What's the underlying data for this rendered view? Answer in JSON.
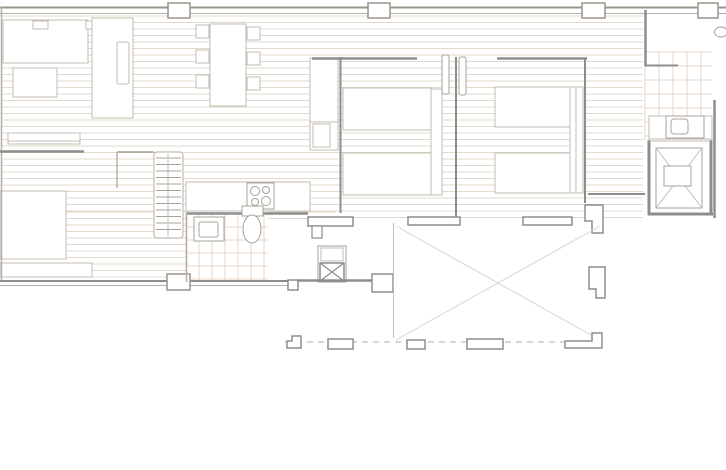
{
  "meta": {
    "title": "apartment-floor-plan",
    "canvas_w": 726,
    "canvas_h": 470,
    "bg": "#ffffff"
  },
  "palette": {
    "wall": "#8d8d8d",
    "wall_mid": "#9a948b",
    "wall_light": "#b6afa7",
    "line": "#c3bbb1",
    "line_dark": "#a8a198",
    "hatch": "#e2d8cc",
    "tile": "#e7d5c8",
    "faint": "#dcd4c9"
  },
  "shapes": [
    {
      "name": "floor-hatch-living",
      "type": "hatch",
      "x": 2,
      "y": 16,
      "w": 334,
      "h": 196,
      "step": 6.5
    },
    {
      "name": "floor-hatch-lower-left",
      "type": "hatch",
      "x": 2,
      "y": 212,
      "w": 184,
      "h": 68,
      "step": 6.5
    },
    {
      "name": "floor-hatch-bedrooms",
      "type": "hatch",
      "x": 336,
      "y": 16,
      "w": 307,
      "h": 202,
      "step": 6.5
    },
    {
      "name": "floor-hatch-utility",
      "type": "hatch",
      "x": 268,
      "y": 212,
      "w": 68,
      "h": 9,
      "step": 6.5
    },
    {
      "name": "tile-grid-bathroom",
      "type": "grid",
      "x": 186,
      "y": 214,
      "w": 82,
      "h": 68,
      "step": 13
    },
    {
      "name": "tile-grid-ensuite",
      "type": "grid",
      "x": 645,
      "y": 52,
      "w": 67,
      "h": 88,
      "step": 14
    },
    {
      "name": "sideboard",
      "type": "rect",
      "x": 3,
      "y": 20,
      "w": 85,
      "h": 43,
      "stroke": "line",
      "sw": 1,
      "fill": "white"
    },
    {
      "name": "sideboard-item",
      "type": "rect",
      "x": 33,
      "y": 21,
      "w": 15,
      "h": 8,
      "stroke": "line",
      "sw": 1,
      "fill": "white"
    },
    {
      "name": "sideboard-item-2",
      "type": "rect",
      "x": 86,
      "y": 21,
      "w": 12,
      "h": 8,
      "stroke": "line",
      "sw": 1,
      "fill": "white"
    },
    {
      "name": "coffee-table",
      "type": "rect",
      "x": 13,
      "y": 68,
      "w": 44,
      "h": 29,
      "stroke": "line",
      "sw": 1,
      "fill": "white"
    },
    {
      "name": "sofa",
      "type": "rect",
      "x": 92,
      "y": 18,
      "w": 41,
      "h": 100,
      "stroke": "line",
      "sw": 1,
      "fill": "white"
    },
    {
      "name": "sofa-cushion",
      "type": "rect",
      "x": 117,
      "y": 42,
      "w": 12,
      "h": 42,
      "rx": 2,
      "stroke": "line",
      "sw": 1,
      "fill": "white"
    },
    {
      "name": "dining-table",
      "type": "rect",
      "x": 210,
      "y": 24,
      "w": 36,
      "h": 82,
      "stroke": "line",
      "sw": 1,
      "fill": "white"
    },
    {
      "name": "chair-1",
      "type": "rect",
      "x": 196,
      "y": 25,
      "w": 13,
      "h": 13,
      "stroke": "line",
      "sw": 1,
      "fill": "white"
    },
    {
      "name": "chair-2",
      "type": "rect",
      "x": 196,
      "y": 50,
      "w": 13,
      "h": 13,
      "stroke": "line",
      "sw": 1,
      "fill": "white"
    },
    {
      "name": "chair-3",
      "type": "rect",
      "x": 196,
      "y": 75,
      "w": 13,
      "h": 13,
      "stroke": "line",
      "sw": 1,
      "fill": "white"
    },
    {
      "name": "chair-4",
      "type": "rect",
      "x": 247,
      "y": 27,
      "w": 13,
      "h": 13,
      "stroke": "line",
      "sw": 1,
      "fill": "white"
    },
    {
      "name": "chair-5",
      "type": "rect",
      "x": 247,
      "y": 52,
      "w": 13,
      "h": 13,
      "stroke": "line",
      "sw": 1,
      "fill": "white"
    },
    {
      "name": "chair-6",
      "type": "rect",
      "x": 247,
      "y": 77,
      "w": 13,
      "h": 13,
      "stroke": "line",
      "sw": 1,
      "fill": "white"
    },
    {
      "name": "wall-console",
      "type": "rect",
      "x": 8,
      "y": 133,
      "w": 72,
      "h": 11,
      "stroke": "line",
      "sw": 1,
      "fill": "white"
    },
    {
      "name": "wall-console-shelf",
      "type": "line",
      "x1": 8,
      "y1": 141,
      "x2": 80,
      "y2": 141,
      "stroke": "line",
      "sw": 1
    },
    {
      "name": "daybed",
      "type": "rect",
      "x": 0,
      "y": 191,
      "w": 66,
      "h": 68,
      "stroke": "line",
      "sw": 1,
      "fill": "white"
    },
    {
      "name": "low-sideboard",
      "type": "rect",
      "x": 0,
      "y": 263,
      "w": 92,
      "h": 14,
      "stroke": "line",
      "sw": 1,
      "fill": "white"
    },
    {
      "name": "stairs",
      "type": "rect",
      "x": 154,
      "y": 152,
      "w": 29,
      "h": 86,
      "rx": 3,
      "stroke": "line",
      "sw": 1.2,
      "fill": "white"
    },
    {
      "name": "stairs-treads",
      "type": "rungs",
      "x": 156,
      "y": 158,
      "w": 25,
      "h": 76,
      "step": 6.5,
      "stroke": "line_dark"
    },
    {
      "name": "stairs-rail",
      "type": "line",
      "x1": 168,
      "y1": 154,
      "x2": 168,
      "y2": 236,
      "stroke": "line",
      "sw": 1
    },
    {
      "name": "kitchen-counter",
      "type": "rect",
      "x": 186,
      "y": 182,
      "w": 124,
      "h": 29,
      "stroke": "line",
      "sw": 1,
      "fill": "white"
    },
    {
      "name": "cooktop",
      "type": "rect",
      "x": 247,
      "y": 183,
      "w": 27,
      "h": 26,
      "stroke": "line_dark",
      "sw": 1,
      "fill": "white"
    },
    {
      "name": "burner-1",
      "type": "circle",
      "cx": 255,
      "cy": 191,
      "r": 4.5,
      "stroke": "line_dark",
      "sw": 1
    },
    {
      "name": "burner-2",
      "type": "circle",
      "cx": 266,
      "cy": 190,
      "r": 3.5,
      "stroke": "line_dark",
      "sw": 1
    },
    {
      "name": "burner-3",
      "type": "circle",
      "cx": 255,
      "cy": 202,
      "r": 3.5,
      "stroke": "line_dark",
      "sw": 1
    },
    {
      "name": "burner-4",
      "type": "circle",
      "cx": 266,
      "cy": 201,
      "r": 4.5,
      "stroke": "line_dark",
      "sw": 1
    },
    {
      "name": "wardrobe",
      "type": "rect",
      "x": 310,
      "y": 58,
      "w": 28,
      "h": 92,
      "stroke": "line",
      "sw": 1,
      "fill": "white"
    },
    {
      "name": "wardrobe-divider",
      "type": "line",
      "x1": 310,
      "y1": 122,
      "x2": 338,
      "y2": 122,
      "stroke": "line",
      "sw": 1
    },
    {
      "name": "wardrobe-shelf",
      "type": "rect",
      "x": 313,
      "y": 124,
      "w": 17,
      "h": 23,
      "stroke": "line",
      "sw": 1,
      "fill": "white"
    },
    {
      "name": "bed-1-left",
      "type": "rect",
      "x": 343,
      "y": 88,
      "w": 88,
      "h": 42,
      "stroke": "line",
      "sw": 1,
      "fill": "white"
    },
    {
      "name": "bed-1-right",
      "type": "rect",
      "x": 343,
      "y": 153,
      "w": 88,
      "h": 42,
      "stroke": "line",
      "sw": 1,
      "fill": "white"
    },
    {
      "name": "bed-1-headboard",
      "type": "rect",
      "x": 431,
      "y": 89,
      "w": 11,
      "h": 106,
      "stroke": "line",
      "sw": 1,
      "fill": "white"
    },
    {
      "name": "bed-2-left",
      "type": "rect",
      "x": 495,
      "y": 87,
      "w": 75,
      "h": 40,
      "stroke": "line",
      "sw": 1,
      "fill": "white"
    },
    {
      "name": "bed-2-right",
      "type": "rect",
      "x": 495,
      "y": 153,
      "w": 75,
      "h": 40,
      "stroke": "line",
      "sw": 1,
      "fill": "white"
    },
    {
      "name": "bed-2-headboard",
      "type": "rect",
      "x": 570,
      "y": 87,
      "w": 13,
      "h": 106,
      "stroke": "line",
      "sw": 1,
      "fill": "white"
    },
    {
      "name": "bed-2-headboard-line",
      "type": "line",
      "x1": 576,
      "y1": 87,
      "x2": 576,
      "y2": 193,
      "stroke": "line",
      "sw": 1
    },
    {
      "name": "washer-box",
      "type": "rect",
      "x": 318,
      "y": 246,
      "w": 28,
      "h": 36,
      "stroke": "line_dark",
      "sw": 1,
      "fill": "white"
    },
    {
      "name": "washer-top",
      "type": "rect",
      "x": 321,
      "y": 248,
      "w": 22,
      "h": 13,
      "stroke": "line",
      "sw": 1,
      "fill": "none"
    },
    {
      "name": "washer-body",
      "type": "rect",
      "x": 320,
      "y": 263,
      "w": 24,
      "h": 18,
      "stroke": "wall",
      "sw": 1.5,
      "fill": "white"
    },
    {
      "name": "washer-cross",
      "type": "xcross",
      "x": 320,
      "y": 263,
      "w": 24,
      "h": 18,
      "stroke": "wall",
      "sw": 1.2
    },
    {
      "name": "wall-top-outer",
      "type": "line",
      "x1": 0,
      "y1": 7.5,
      "x2": 726,
      "y2": 7.5,
      "stroke": "wall_mid",
      "sw": 2
    },
    {
      "name": "wall-top-inner",
      "type": "line",
      "x1": 0,
      "y1": 13.5,
      "x2": 726,
      "y2": 13.5,
      "stroke": "wall_light",
      "sw": 1
    },
    {
      "name": "wall-left",
      "type": "line",
      "x1": 1.5,
      "y1": 7,
      "x2": 1.5,
      "y2": 282,
      "stroke": "wall_light",
      "sw": 1.5
    },
    {
      "name": "wall-bottom-outer",
      "type": "line",
      "x1": 0,
      "y1": 281,
      "x2": 298,
      "y2": 281,
      "stroke": "wall",
      "sw": 2
    },
    {
      "name": "wall-bottom-inner",
      "type": "line",
      "x1": 0,
      "y1": 285.5,
      "x2": 298,
      "y2": 285.5,
      "stroke": "wall_light",
      "sw": 1
    },
    {
      "name": "pier-top-1",
      "type": "rect",
      "x": 168,
      "y": 3,
      "w": 22,
      "h": 15,
      "stroke": "wall_mid",
      "sw": 1.5,
      "fill": "white"
    },
    {
      "name": "pier-top-2",
      "type": "rect",
      "x": 368,
      "y": 3,
      "w": 22,
      "h": 15,
      "stroke": "wall_mid",
      "sw": 1.5,
      "fill": "white"
    },
    {
      "name": "pier-top-3",
      "type": "rect",
      "x": 582,
      "y": 3,
      "w": 23,
      "h": 15,
      "stroke": "wall_mid",
      "sw": 1.5,
      "fill": "white"
    },
    {
      "name": "pier-top-4",
      "type": "rect",
      "x": 698,
      "y": 3,
      "w": 20,
      "h": 15,
      "stroke": "wall_mid",
      "sw": 1.5,
      "fill": "white"
    },
    {
      "name": "pier-bottom",
      "type": "rect",
      "x": 167,
      "y": 274,
      "w": 23,
      "h": 16,
      "stroke": "wall_mid",
      "sw": 1.5,
      "fill": "white"
    },
    {
      "name": "wall-bed1-top",
      "type": "line",
      "x1": 312,
      "y1": 58.5,
      "x2": 417,
      "y2": 58.5,
      "stroke": "wall",
      "sw": 2.5
    },
    {
      "name": "wall-bed2-top",
      "type": "line",
      "x1": 497,
      "y1": 58.5,
      "x2": 587,
      "y2": 58.5,
      "stroke": "wall",
      "sw": 2.5
    },
    {
      "name": "wall-bed1-left",
      "type": "line",
      "x1": 340.5,
      "y1": 57,
      "x2": 340.5,
      "y2": 213,
      "stroke": "wall",
      "sw": 2
    },
    {
      "name": "wall-bed-divider",
      "type": "line",
      "x1": 456,
      "y1": 57,
      "x2": 456,
      "y2": 220,
      "stroke": "wall",
      "sw": 2
    },
    {
      "name": "wall-bed2-right",
      "type": "line",
      "x1": 585,
      "y1": 58,
      "x2": 585,
      "y2": 203,
      "stroke": "wall",
      "sw": 2
    },
    {
      "name": "wall-hall-right",
      "type": "line",
      "x1": 588,
      "y1": 194,
      "x2": 645,
      "y2": 194,
      "stroke": "wall",
      "sw": 2
    },
    {
      "name": "door-leaf-1",
      "type": "rect",
      "x": 442,
      "y": 55,
      "w": 7,
      "h": 39,
      "rx": 2,
      "stroke": "line_dark",
      "sw": 1,
      "fill": "white"
    },
    {
      "name": "door-leaf-2",
      "type": "rect",
      "x": 459,
      "y": 57,
      "w": 7,
      "h": 38,
      "rx": 2,
      "stroke": "line_dark",
      "sw": 1,
      "fill": "white"
    },
    {
      "name": "wall-ensuite-left",
      "type": "line",
      "x1": 645.5,
      "y1": 10,
      "x2": 645.5,
      "y2": 66,
      "stroke": "wall",
      "sw": 2.5
    },
    {
      "name": "wall-ensuite-stub",
      "type": "line",
      "x1": 645,
      "y1": 65.5,
      "x2": 678,
      "y2": 65.5,
      "stroke": "wall",
      "sw": 2
    },
    {
      "name": "wall-right",
      "type": "line",
      "x1": 714.5,
      "y1": 100,
      "x2": 714.5,
      "y2": 218,
      "stroke": "wall",
      "sw": 2.5
    },
    {
      "name": "elevator-wall-left",
      "type": "line",
      "x1": 649,
      "y1": 140,
      "x2": 649,
      "y2": 215,
      "stroke": "wall",
      "sw": 3
    },
    {
      "name": "elevator-wall-bottom",
      "type": "line",
      "x1": 648,
      "y1": 214,
      "x2": 713,
      "y2": 214,
      "stroke": "wall",
      "sw": 3
    },
    {
      "name": "elevator-wall-right",
      "type": "line",
      "x1": 711,
      "y1": 140,
      "x2": 711,
      "y2": 215,
      "stroke": "wall",
      "sw": 3
    },
    {
      "name": "elevator-door-line",
      "type": "line",
      "x1": 649,
      "y1": 141,
      "x2": 711,
      "y2": 141,
      "stroke": "line",
      "sw": 1
    },
    {
      "name": "elevator-car",
      "type": "rect",
      "x": 656,
      "y": 148,
      "w": 46,
      "h": 60,
      "stroke": "line_dark",
      "sw": 1,
      "fill": "white"
    },
    {
      "name": "elevator-cross",
      "type": "xcross",
      "x": 656,
      "y": 148,
      "w": 46,
      "h": 60,
      "stroke": "line",
      "sw": 1
    },
    {
      "name": "elevator-inner",
      "type": "rect",
      "x": 664,
      "y": 166,
      "w": 27,
      "h": 20,
      "stroke": "line_dark",
      "sw": 1,
      "fill": "white"
    },
    {
      "name": "vanity-counter",
      "type": "rect",
      "x": 649,
      "y": 116,
      "w": 63,
      "h": 23,
      "stroke": "line",
      "sw": 1,
      "fill": "white"
    },
    {
      "name": "vanity-sink",
      "type": "rect",
      "x": 666,
      "y": 116,
      "w": 38,
      "h": 22,
      "stroke": "line_dark",
      "sw": 1,
      "fill": "white"
    },
    {
      "name": "vanity-sink-basin",
      "type": "rect",
      "x": 671,
      "y": 119,
      "w": 17,
      "h": 15,
      "rx": 3,
      "stroke": "line_dark",
      "sw": 1,
      "fill": "white"
    },
    {
      "name": "wall-kitchen-bath",
      "type": "line",
      "x1": 186,
      "y1": 213.5,
      "x2": 308,
      "y2": 213.5,
      "stroke": "wall",
      "sw": 2.5
    },
    {
      "name": "wall-bath-left",
      "type": "line",
      "x1": 186.5,
      "y1": 213,
      "x2": 186.5,
      "y2": 282,
      "stroke": "wall_light",
      "sw": 1.5
    },
    {
      "name": "washbasin",
      "type": "rect",
      "x": 194,
      "y": 217,
      "w": 30,
      "h": 24,
      "stroke": "line_dark",
      "sw": 1,
      "fill": "white"
    },
    {
      "name": "washbasin-bowl",
      "type": "rect",
      "x": 199,
      "y": 222,
      "w": 19,
      "h": 15,
      "rx": 2,
      "stroke": "line_dark",
      "sw": 1,
      "fill": "white"
    },
    {
      "name": "toilet-tank",
      "type": "rect",
      "x": 242,
      "y": 206,
      "w": 21,
      "h": 10,
      "stroke": "line_dark",
      "sw": 1,
      "fill": "white"
    },
    {
      "name": "toilet-bowl",
      "type": "ellipse",
      "cx": 252,
      "cy": 229,
      "rx": 9,
      "ry": 14,
      "stroke": "line_dark",
      "sw": 1,
      "fill": "white"
    },
    {
      "name": "terrace-door-pier",
      "type": "rect",
      "x": 308,
      "y": 217,
      "w": 45,
      "h": 9,
      "stroke": "wall",
      "sw": 1.5,
      "fill": "white"
    },
    {
      "name": "terrace-door-pier-stub",
      "type": "rect",
      "x": 312,
      "y": 226,
      "w": 10,
      "h": 12,
      "stroke": "wall",
      "sw": 1.2,
      "fill": "white"
    },
    {
      "name": "terrace-sill-1",
      "type": "rect",
      "x": 408,
      "y": 217,
      "w": 52,
      "h": 8,
      "stroke": "wall",
      "sw": 1.5,
      "fill": "white"
    },
    {
      "name": "terrace-sill-2",
      "type": "rect",
      "x": 523,
      "y": 217,
      "w": 49,
      "h": 8,
      "stroke": "wall",
      "sw": 1.5,
      "fill": "white"
    },
    {
      "name": "terrace-column-ne",
      "type": "poly",
      "points": "585,205 603,205 603,233 592,233 592,221 585,221",
      "stroke": "wall",
      "sw": 1.5,
      "fill": "white"
    },
    {
      "name": "terrace-column-e",
      "type": "poly",
      "points": "589,267 605,267 605,298 596,298 596,289 589,289",
      "stroke": "wall",
      "sw": 1.5,
      "fill": "white"
    },
    {
      "name": "utility-step",
      "type": "rect",
      "x": 288,
      "y": 280,
      "w": 10,
      "h": 10,
      "stroke": "wall",
      "sw": 1.5,
      "fill": "white"
    },
    {
      "name": "wall-utility-bottom",
      "type": "line",
      "x1": 297,
      "y1": 280.5,
      "x2": 372,
      "y2": 280.5,
      "stroke": "wall",
      "sw": 2.5
    },
    {
      "name": "utility-pier",
      "type": "rect",
      "x": 372,
      "y": 274,
      "w": 21,
      "h": 18,
      "stroke": "wall",
      "sw": 1.5,
      "fill": "white"
    },
    {
      "name": "terrace-edge-line",
      "type": "line",
      "x1": 393.5,
      "y1": 223,
      "x2": 393.5,
      "y2": 338,
      "stroke": "line",
      "sw": 1
    },
    {
      "name": "terrace-diag-1",
      "type": "line",
      "x1": 396,
      "y1": 226,
      "x2": 600,
      "y2": 340,
      "stroke": "faint",
      "sw": 1
    },
    {
      "name": "terrace-diag-2",
      "type": "line",
      "x1": 396,
      "y1": 340,
      "x2": 600,
      "y2": 226,
      "stroke": "faint",
      "sw": 1
    },
    {
      "name": "terrace-boundary-dashed",
      "type": "line",
      "x1": 285,
      "y1": 342,
      "x2": 602,
      "y2": 342,
      "stroke": "wall_light",
      "sw": 1,
      "dash": "6 5"
    },
    {
      "name": "terrace-post-1",
      "type": "poly",
      "points": "287,341 292,341 292,336 301,336 301,348 287,348",
      "stroke": "wall",
      "sw": 1.5,
      "fill": "white"
    },
    {
      "name": "terrace-post-2",
      "type": "rect",
      "x": 328,
      "y": 339,
      "w": 25,
      "h": 10,
      "stroke": "wall",
      "sw": 1.5,
      "fill": "white"
    },
    {
      "name": "terrace-post-3",
      "type": "rect",
      "x": 407,
      "y": 340,
      "w": 18,
      "h": 9,
      "stroke": "wall",
      "sw": 1.5,
      "fill": "white"
    },
    {
      "name": "terrace-post-4",
      "type": "rect",
      "x": 467,
      "y": 339,
      "w": 36,
      "h": 10,
      "stroke": "wall",
      "sw": 1.5,
      "fill": "white"
    },
    {
      "name": "terrace-post-5",
      "type": "poly",
      "points": "565,341 592,341 592,333 602,333 602,348 565,348",
      "stroke": "wall",
      "sw": 1.5,
      "fill": "white"
    },
    {
      "name": "wall-study-stub",
      "type": "line",
      "x1": 0,
      "y1": 151.5,
      "x2": 84,
      "y2": 151.5,
      "stroke": "wall",
      "sw": 2.5
    },
    {
      "name": "wall-stairs-top",
      "type": "line",
      "x1": 117,
      "y1": 152,
      "x2": 154,
      "y2": 152,
      "stroke": "line_dark",
      "sw": 1.5
    },
    {
      "name": "wall-stairs-side",
      "type": "line",
      "x1": 117,
      "y1": 152,
      "x2": 117,
      "y2": 188,
      "stroke": "line_dark",
      "sw": 1.2
    },
    {
      "name": "entry-door-knob",
      "type": "ellipse",
      "cx": 721,
      "cy": 32,
      "rx": 6.5,
      "ry": 5,
      "stroke": "line_dark",
      "sw": 1,
      "fill": "white"
    }
  ]
}
